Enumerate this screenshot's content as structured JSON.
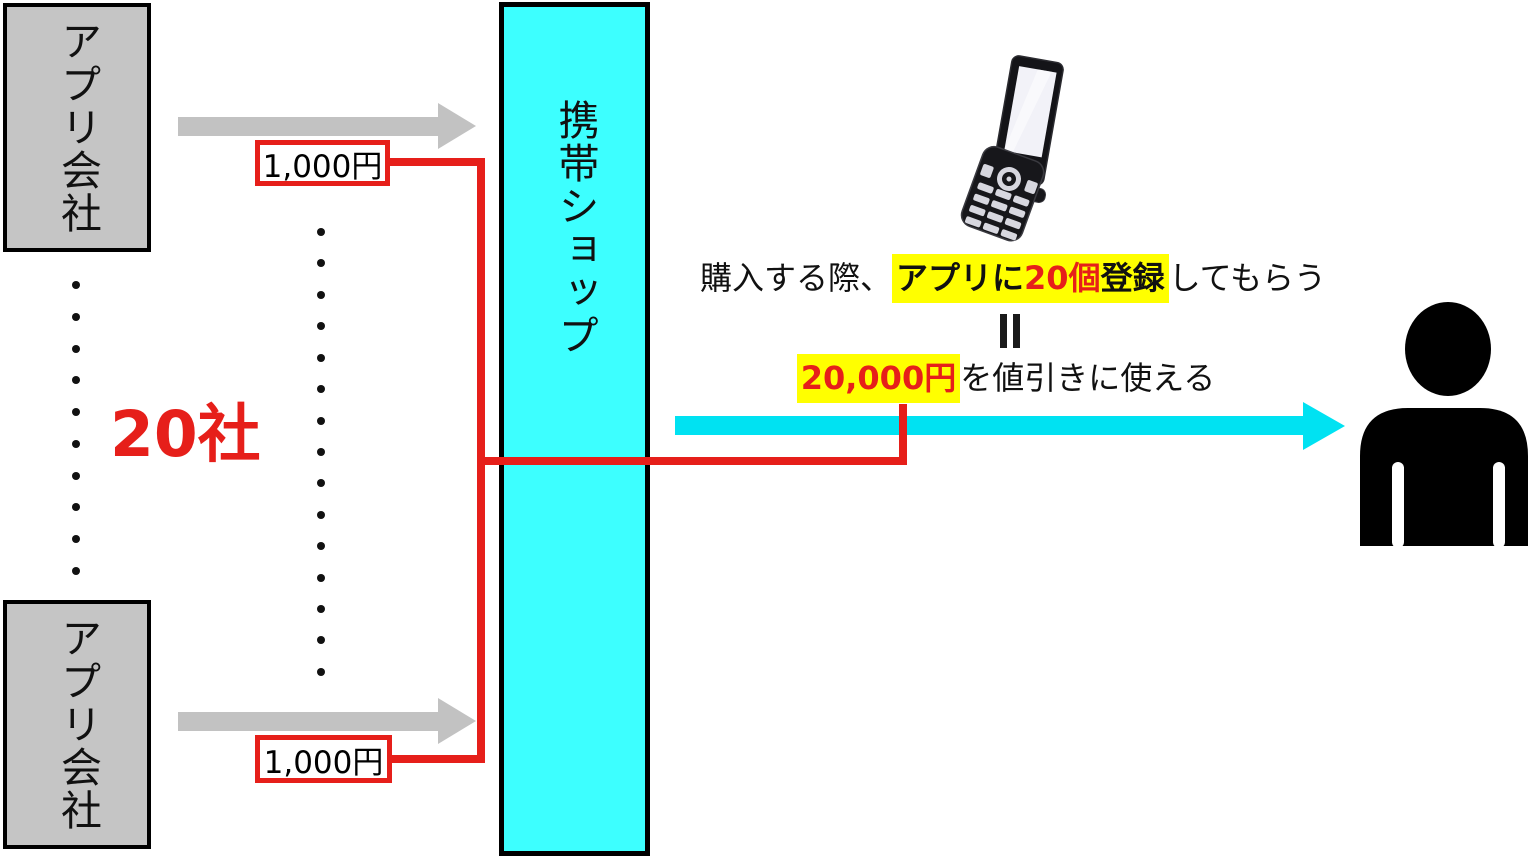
{
  "colors": {
    "red": "#e61f1a",
    "gray_fill": "#c5c5c5",
    "gray_arrow": "#c2c2c2",
    "cyan_fill": "#3dffff",
    "cyan_arrow": "#00e2f2",
    "yellow": "#ffff00"
  },
  "companies": {
    "top_label": "アプリ会社",
    "bottom_label": "アプリ会社",
    "count_label": "20社"
  },
  "payments": {
    "top_amount": "1,000円",
    "bottom_amount": "1,000円"
  },
  "shop": {
    "label": "携帯ショップ"
  },
  "offer": {
    "line1_prefix": "購入する際、",
    "line1_hl_bold1": "アプリに",
    "line1_hl_red": "20個",
    "line1_hl_bold2": "登録",
    "line1_suffix": "してもらう",
    "equals_symbol": "＝",
    "line2_hl_red": "20,000円",
    "line2_suffix": "を値引きに使える"
  },
  "decor": {
    "left_dots": 10,
    "middle_dots": 15
  },
  "icons": {
    "phone": "flip-phone-icon",
    "person": "person-icon"
  }
}
